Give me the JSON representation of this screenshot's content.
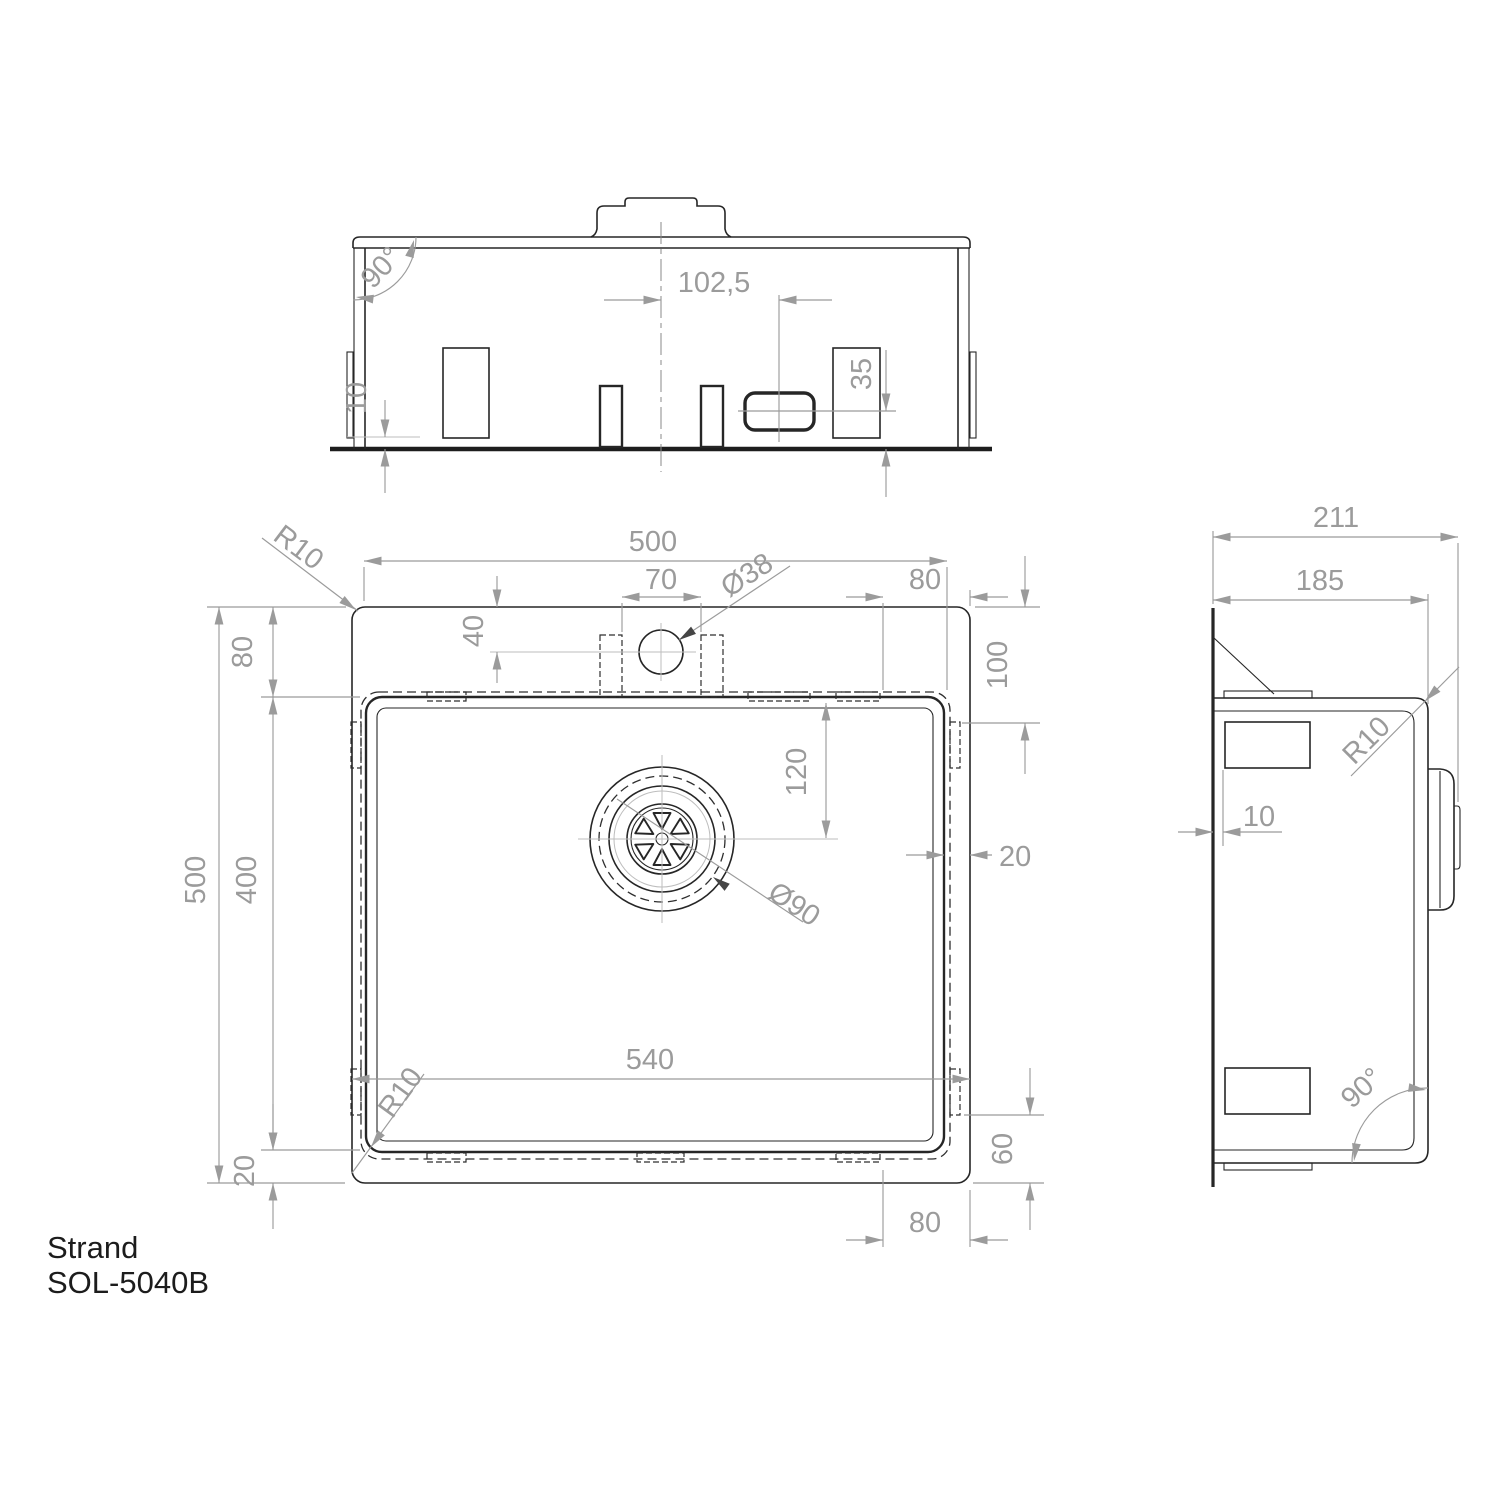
{
  "title": {
    "product": "Strand",
    "model": "SOL-5040B"
  },
  "colors": {
    "line": "#262626",
    "dimension": "#9b9b9b",
    "background": "#ffffff"
  },
  "views": {
    "front": {
      "dims": {
        "angle": "90°",
        "center_offset": "102,5",
        "overflow_height": "35",
        "clip_gap": "10"
      }
    },
    "plan": {
      "dims": {
        "bowl_width": "500",
        "tap_bracket_gap": "70",
        "tap_hole_dia": "Ø38",
        "back_clip_edge": "80",
        "tap_hole_depth": "40",
        "rim_back": "80",
        "back_clip_offset": "100",
        "drain_offset": "120",
        "rim_right": "20",
        "overall_depth": "500",
        "bowl_depth": "400",
        "overall_width": "540",
        "flange_corner_radius": "R10",
        "bowl_corner_radius": "R10",
        "rim_front": "20",
        "front_clip_offset": "60",
        "front_clip_edge": "80",
        "drain_dia": "Ø90"
      }
    },
    "side": {
      "dims": {
        "total_height": "211",
        "body_height": "185",
        "corner_radius": "R10",
        "clip_inset": "10",
        "angle": "90°"
      }
    }
  }
}
